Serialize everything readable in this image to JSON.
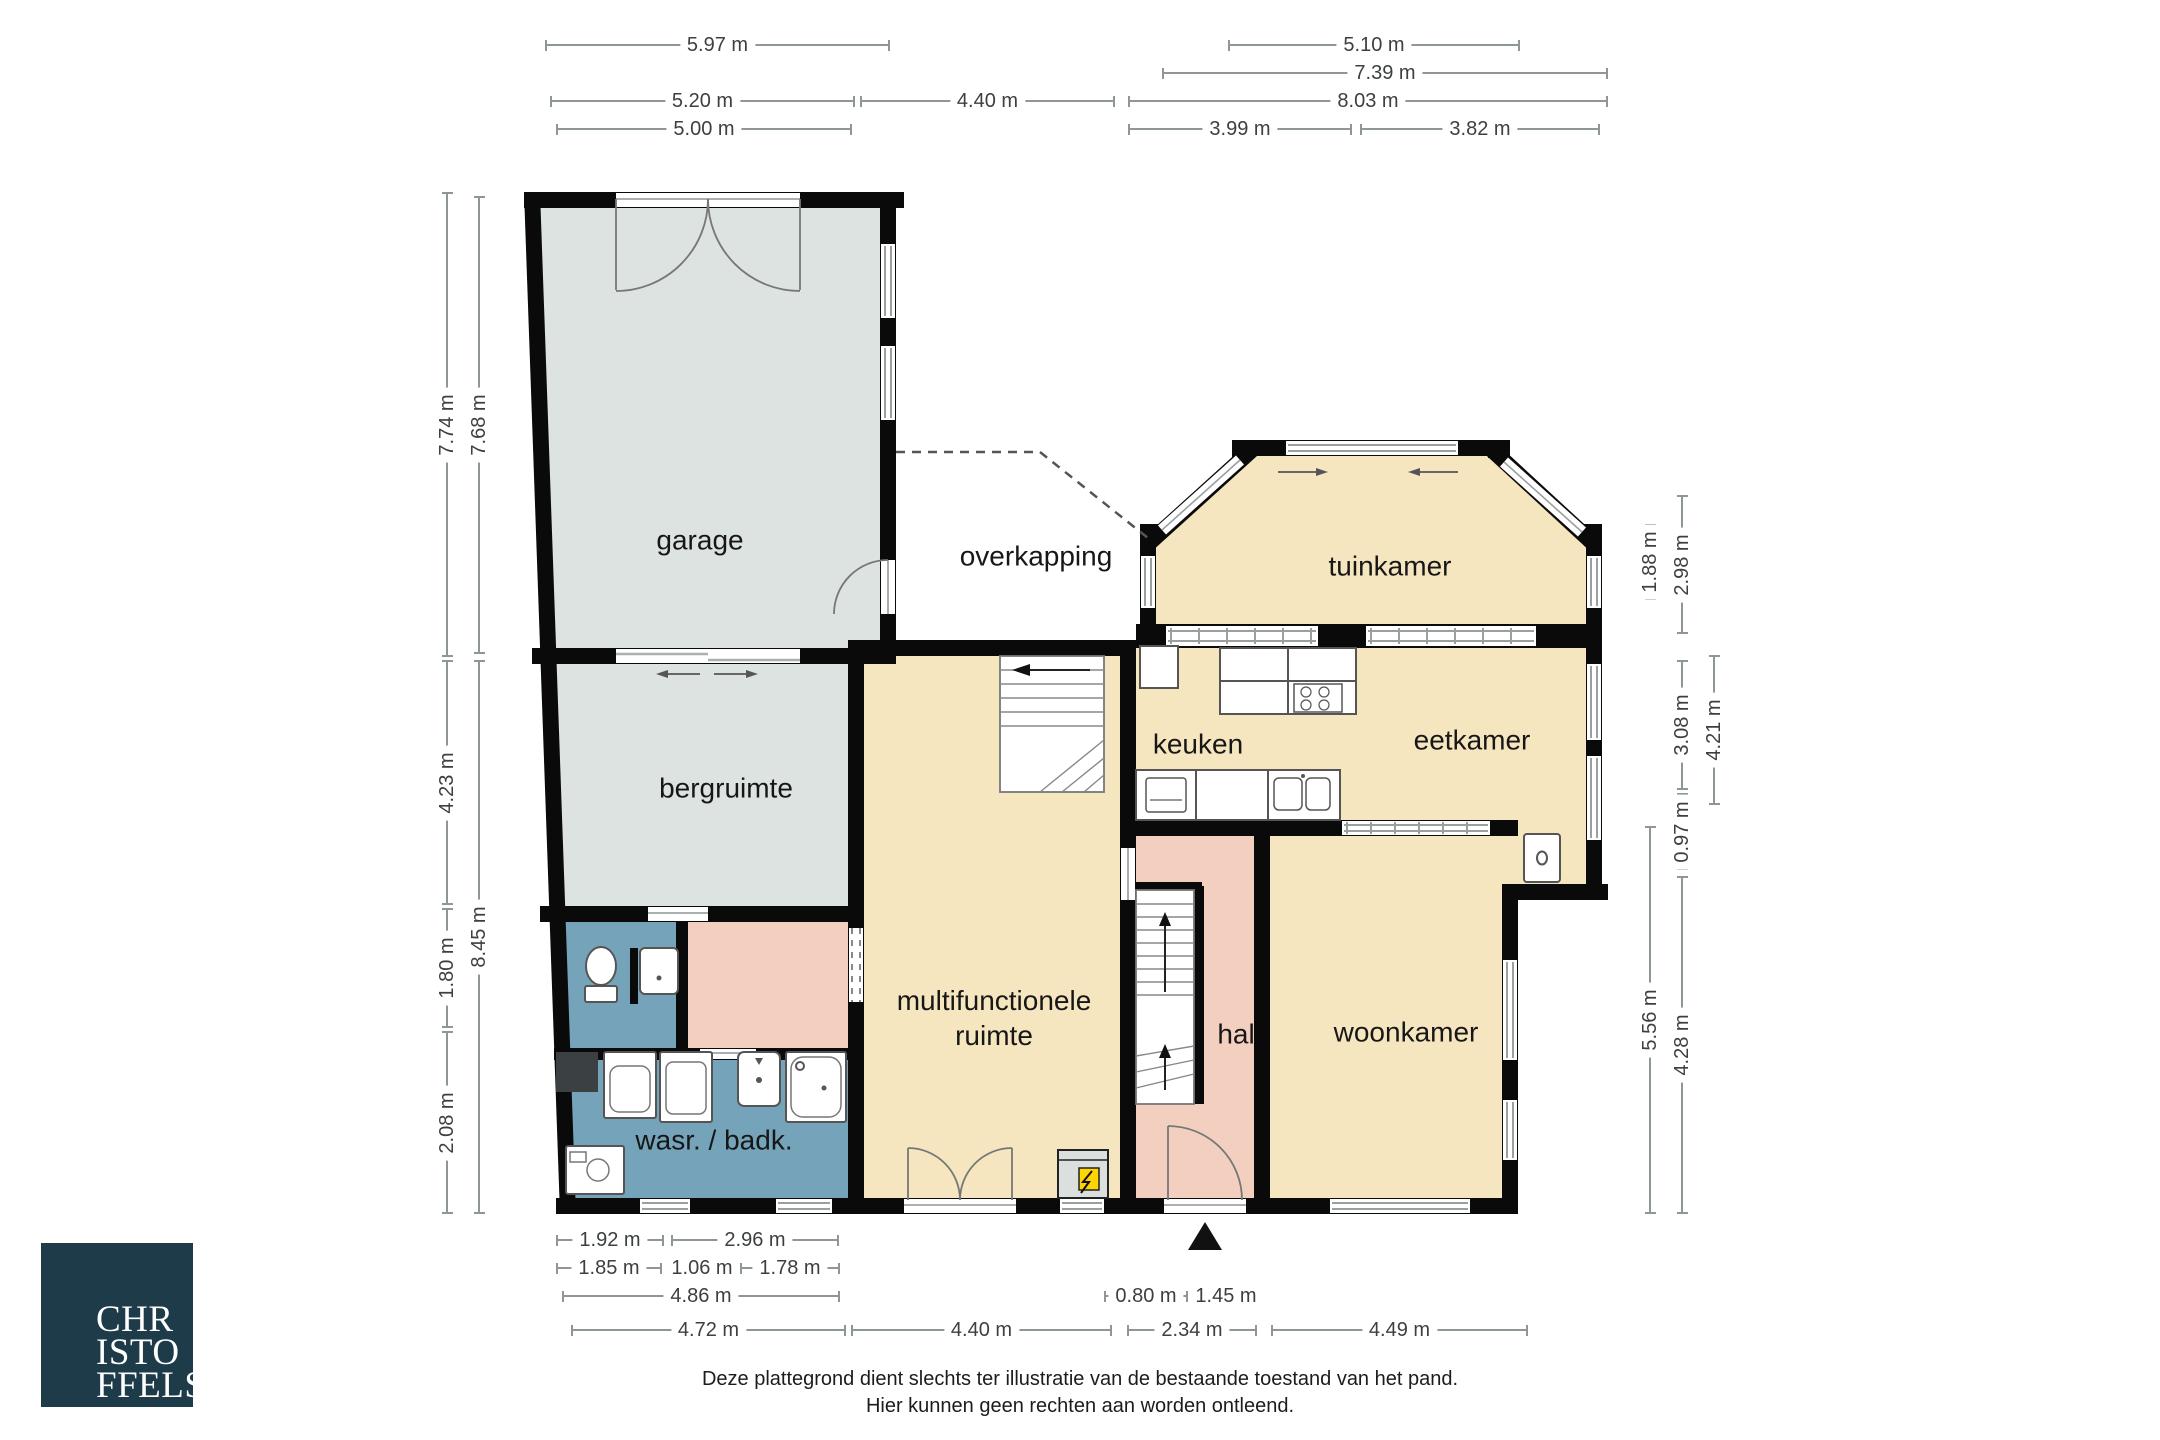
{
  "plan": {
    "rooms": [
      {
        "id": "garage",
        "label": "garage",
        "x": 700,
        "y": 540
      },
      {
        "id": "overkapping",
        "label": "overkapping",
        "x": 1036,
        "y": 556
      },
      {
        "id": "tuinkamer",
        "label": "tuinkamer",
        "x": 1390,
        "y": 566
      },
      {
        "id": "keuken",
        "label": "keuken",
        "x": 1198,
        "y": 744
      },
      {
        "id": "eetkamer",
        "label": "eetkamer",
        "x": 1472,
        "y": 740
      },
      {
        "id": "bergruimte",
        "label": "bergruimte",
        "x": 726,
        "y": 788
      },
      {
        "id": "multifunctionele-ruimte",
        "label": "multifunctionele\nruimte",
        "x": 994,
        "y": 1018
      },
      {
        "id": "hal",
        "label": "hal",
        "x": 1236,
        "y": 1034
      },
      {
        "id": "woonkamer",
        "label": "woonkamer",
        "x": 1406,
        "y": 1032
      },
      {
        "id": "wasruimte-badkamer",
        "label": "wasr. / badk.",
        "x": 714,
        "y": 1140
      }
    ],
    "dimensions": [
      {
        "label": "5.97 m",
        "orient": "h",
        "x1": 545,
        "x2": 890,
        "y": 45,
        "side": "top"
      },
      {
        "label": "5.10 m",
        "orient": "h",
        "x1": 1228,
        "x2": 1520,
        "y": 45,
        "side": "top"
      },
      {
        "label": "7.39 m",
        "orient": "h",
        "x1": 1162,
        "x2": 1608,
        "y": 73,
        "side": "top"
      },
      {
        "label": "5.20 m",
        "orient": "h",
        "x1": 550,
        "x2": 855,
        "y": 101,
        "side": "top"
      },
      {
        "label": "4.40 m",
        "orient": "h",
        "x1": 860,
        "x2": 1115,
        "y": 101,
        "side": "top"
      },
      {
        "label": "8.03 m",
        "orient": "h",
        "x1": 1128,
        "x2": 1608,
        "y": 101,
        "side": "top"
      },
      {
        "label": "5.00 m",
        "orient": "h",
        "x1": 556,
        "x2": 852,
        "y": 129,
        "side": "top"
      },
      {
        "label": "3.99 m",
        "orient": "h",
        "x1": 1128,
        "x2": 1352,
        "y": 129,
        "side": "top"
      },
      {
        "label": "3.82 m",
        "orient": "h",
        "x1": 1360,
        "x2": 1600,
        "y": 129,
        "side": "top"
      },
      {
        "label": "7.74 m",
        "orient": "v",
        "y1": 192,
        "y2": 657,
        "x": 447,
        "side": "left"
      },
      {
        "label": "7.68 m",
        "orient": "v",
        "y1": 196,
        "y2": 654,
        "x": 479,
        "side": "left"
      },
      {
        "label": "4.23 m",
        "orient": "v",
        "y1": 660,
        "y2": 905,
        "x": 447,
        "side": "left"
      },
      {
        "label": "8.45 m",
        "orient": "v",
        "y1": 660,
        "y2": 1214,
        "x": 479,
        "side": "left"
      },
      {
        "label": "1.80 m",
        "orient": "v",
        "y1": 908,
        "y2": 1028,
        "x": 447,
        "side": "left"
      },
      {
        "label": "2.08 m",
        "orient": "v",
        "y1": 1031,
        "y2": 1214,
        "x": 447,
        "side": "left"
      },
      {
        "label": "1.88 m",
        "orient": "v",
        "y1": 524,
        "y2": 600,
        "x": 1650,
        "side": "right"
      },
      {
        "label": "2.98 m",
        "orient": "v",
        "y1": 495,
        "y2": 634,
        "x": 1682,
        "side": "right"
      },
      {
        "label": "3.08 m",
        "orient": "v",
        "y1": 660,
        "y2": 790,
        "x": 1682,
        "side": "right"
      },
      {
        "label": "4.21 m",
        "orient": "v",
        "y1": 655,
        "y2": 805,
        "x": 1714,
        "side": "right"
      },
      {
        "label": "0.97 m",
        "orient": "v",
        "y1": 793,
        "y2": 870,
        "x": 1682,
        "side": "right"
      },
      {
        "label": "5.56 m",
        "orient": "v",
        "y1": 826,
        "y2": 1214,
        "x": 1650,
        "side": "right"
      },
      {
        "label": "4.28 m",
        "orient": "v",
        "y1": 876,
        "y2": 1214,
        "x": 1682,
        "side": "right"
      },
      {
        "label": "1.92 m",
        "orient": "h",
        "x1": 556,
        "x2": 664,
        "y": 1240,
        "side": "bottom"
      },
      {
        "label": "2.96 m",
        "orient": "h",
        "x1": 671,
        "x2": 839,
        "y": 1240,
        "side": "bottom"
      },
      {
        "label": "1.85 m",
        "orient": "h",
        "x1": 556,
        "x2": 662,
        "y": 1268,
        "side": "bottom"
      },
      {
        "label": "1.06 m",
        "orient": "h",
        "x1": 668,
        "x2": 736,
        "y": 1268,
        "side": "bottom"
      },
      {
        "label": "1.78 m",
        "orient": "h",
        "x1": 740,
        "x2": 840,
        "y": 1268,
        "side": "bottom"
      },
      {
        "label": "4.86 m",
        "orient": "h",
        "x1": 562,
        "x2": 840,
        "y": 1296,
        "side": "bottom"
      },
      {
        "label": "0.80 m",
        "orient": "h",
        "x1": 1104,
        "x2": 1188,
        "y": 1296,
        "side": "bottom"
      },
      {
        "label": "1.45 m",
        "orient": "h",
        "x1": 1190,
        "x2": 1262,
        "y": 1296,
        "side": "bottom"
      },
      {
        "label": "4.72 m",
        "orient": "h",
        "x1": 571,
        "x2": 846,
        "y": 1330,
        "side": "bottom"
      },
      {
        "label": "4.40 m",
        "orient": "h",
        "x1": 851,
        "x2": 1112,
        "y": 1330,
        "side": "bottom"
      },
      {
        "label": "2.34 m",
        "orient": "h",
        "x1": 1127,
        "x2": 1257,
        "y": 1330,
        "side": "bottom"
      },
      {
        "label": "4.49 m",
        "orient": "h",
        "x1": 1271,
        "x2": 1528,
        "y": 1330,
        "side": "bottom"
      }
    ],
    "colors": {
      "room_cream": "#f6e6c0",
      "room_gray": "#dde3e1",
      "room_salmon": "#f3cfbf",
      "room_blue": "#74a3ba",
      "wall": "#0a0a0a",
      "thin_line": "#9aa0a0",
      "dim_line": "#8f9696",
      "dim_text": "#3c4040",
      "label_text": "#171717",
      "logo_bg": "#1d3b49",
      "logo_text": "#ffffff",
      "meter_yellow": "#fed500"
    }
  },
  "footer": {
    "disclaimer_line1": "Deze plattegrond dient slechts ter illustratie van de bestaande toestand van het pand.",
    "disclaimer_line2": "Hier kunnen geen rechten aan worden ontleend."
  },
  "logo": {
    "line1": "CHR",
    "line2": "ISTO",
    "line3": "FFELS"
  }
}
